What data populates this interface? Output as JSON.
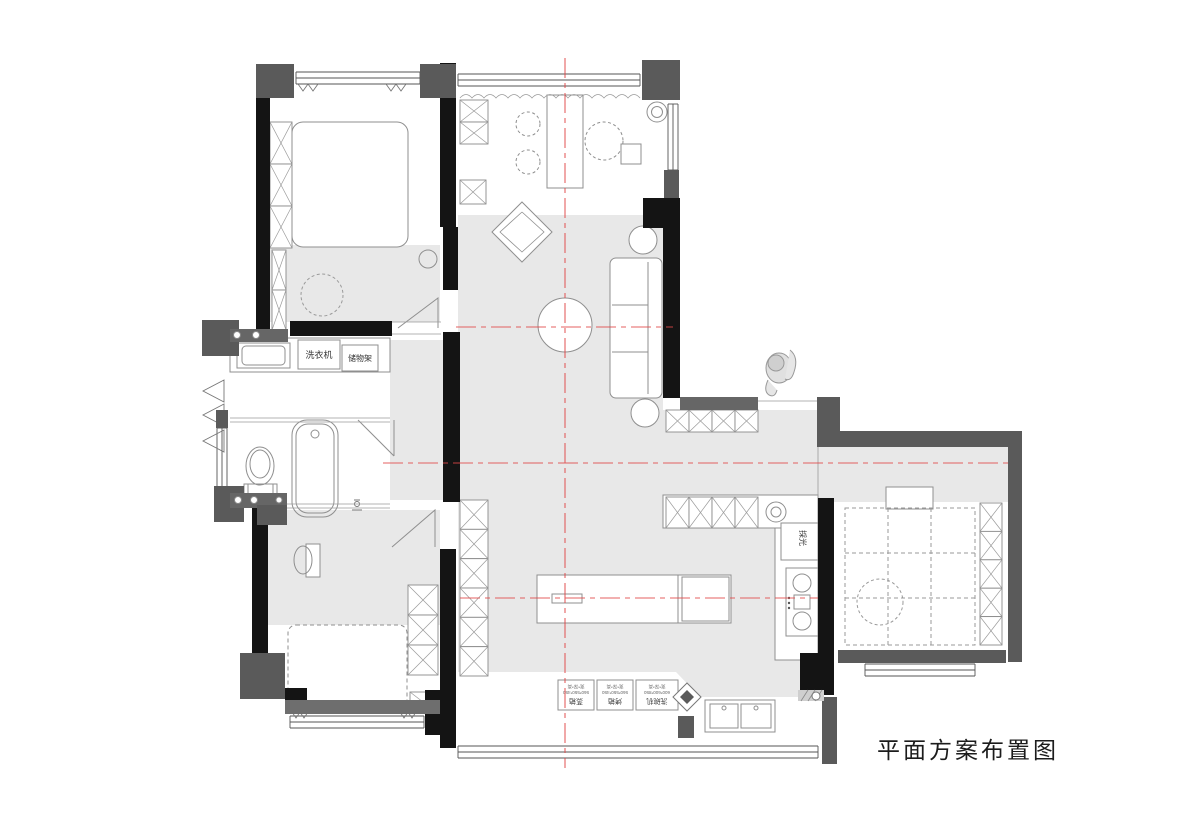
{
  "title": "平面方案布置图",
  "colors": {
    "wall": "#141414",
    "pier": "#5a5a5a",
    "floor": "#e8e8e8",
    "centerline": "#e04646",
    "outline": "#8f8f8f"
  },
  "labels": {
    "washing_machine": "洗衣机",
    "storage_rack": "储物架",
    "daylight": "採光",
    "appliances": [
      {
        "name": "蒸箱",
        "dims": "560*550*450",
        "note": "宽*深*高"
      },
      {
        "name": "烤箱",
        "dims": "560*550*450",
        "note": "宽*深*高"
      },
      {
        "name": "洗碗机",
        "dims": "600*600*850",
        "note": "宽*深*高"
      }
    ]
  }
}
